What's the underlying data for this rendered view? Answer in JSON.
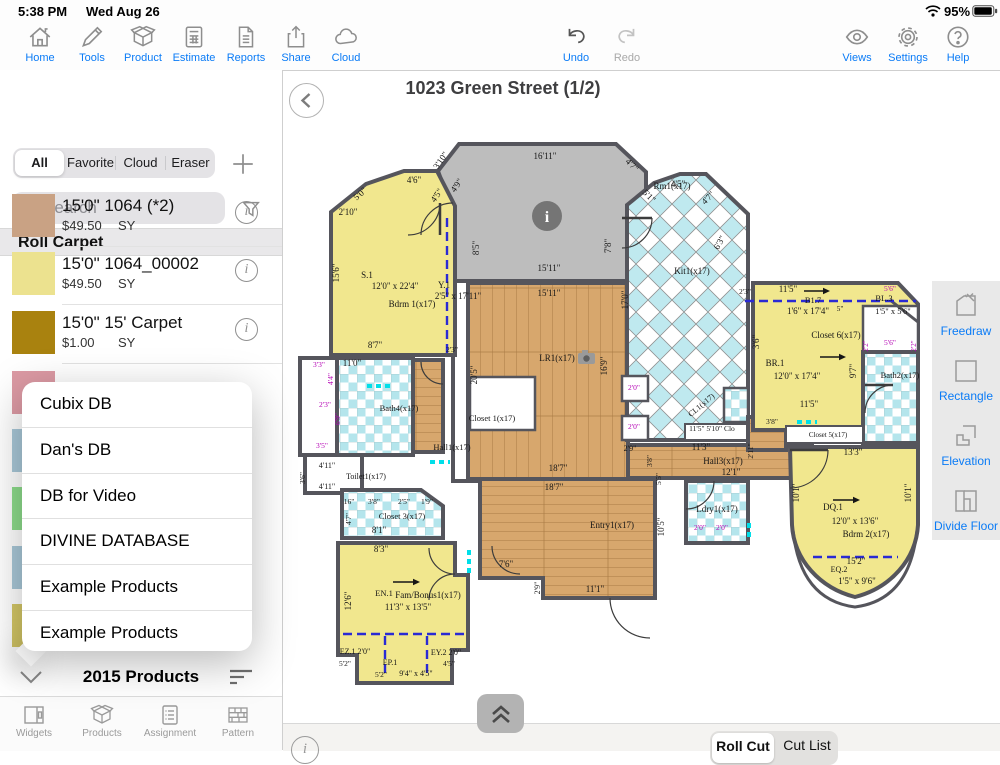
{
  "status_bar": {
    "time": "5:38 PM",
    "date": "Wed Aug 26",
    "battery_percent": "95%"
  },
  "toolbar": {
    "left": [
      {
        "label": "Home"
      },
      {
        "label": "Tools"
      },
      {
        "label": "Product"
      },
      {
        "label": "Estimate"
      },
      {
        "label": "Reports"
      },
      {
        "label": "Share"
      },
      {
        "label": "Cloud"
      }
    ],
    "center": [
      {
        "label": "Undo"
      },
      {
        "label": "Redo"
      }
    ],
    "right": [
      {
        "label": "Views"
      },
      {
        "label": "Settings"
      },
      {
        "label": "Help"
      }
    ]
  },
  "sidebar": {
    "filters": [
      {
        "label": "All"
      },
      {
        "label": "Favorite"
      },
      {
        "label": "Cloud"
      },
      {
        "label": "Eraser"
      }
    ],
    "search": {
      "placeholder": "Search"
    },
    "section_header": "Roll Carpet",
    "products": [
      {
        "name": "15'0\" 1064  (*2)",
        "price": "$49.50",
        "unit": "SY",
        "swatch": "#c9a284"
      },
      {
        "name": "15'0\" 1064_00002",
        "price": "$49.50",
        "unit": "SY",
        "swatch": "#ece28f"
      },
      {
        "name": "15'0\" 15' Carpet",
        "price": "$1.00",
        "unit": "SY",
        "swatch": "#a9820f"
      }
    ],
    "partial_swatches": [
      "#dc9aa4",
      "#a9c8d8",
      "#8ddc8b",
      "#a9c8d8",
      "#d4c766"
    ],
    "db_menu": [
      "Cubix DB",
      "Dan's DB",
      "DB for Video",
      "DIVINE DATABASE",
      "Example Products",
      "Example Products"
    ],
    "footer_label": "2015 Products",
    "tabbar": [
      {
        "label": "Widgets"
      },
      {
        "label": "Products"
      },
      {
        "label": "Assignment"
      },
      {
        "label": "Pattern"
      }
    ]
  },
  "canvas": {
    "title": "1023 Green Street (1/2)",
    "info_marker_glyph": "i",
    "tools": [
      {
        "label": "Freedraw"
      },
      {
        "label": "Rectangle"
      },
      {
        "label": "Elevation"
      },
      {
        "label": "Divide Floor"
      }
    ],
    "bottom_tabs": [
      {
        "label": "Roll Cut"
      },
      {
        "label": "Cut List"
      }
    ],
    "plan": {
      "labels": [
        {
          "t": "16'11\"",
          "x": 545,
          "y": 159
        },
        {
          "t": "Rm1(x17)",
          "x": 672,
          "y": 189
        },
        {
          "t": "15'11\"",
          "x": 549,
          "y": 271
        },
        {
          "t": "15'11\"",
          "x": 549,
          "y": 296
        },
        {
          "t": "8'5\"",
          "x": 479,
          "y": 248,
          "r": -90
        },
        {
          "t": "3'10\"",
          "x": 443,
          "y": 162,
          "r": -55
        },
        {
          "t": "4'9\"",
          "x": 459,
          "y": 187,
          "r": -55
        },
        {
          "t": "4'5\"",
          "x": 439,
          "y": 197,
          "r": -55
        },
        {
          "t": "2'10\"",
          "x": 348,
          "y": 215
        },
        {
          "t": "5'0\"",
          "x": 362,
          "y": 196,
          "r": -42
        },
        {
          "t": "4'6\"",
          "x": 414,
          "y": 183
        },
        {
          "t": "15'6\"",
          "x": 339,
          "y": 273,
          "r": -90
        },
        {
          "t": "S.1",
          "x": 367,
          "y": 278
        },
        {
          "t": "12'0\" x 22'4\"",
          "x": 395,
          "y": 289
        },
        {
          "t": "Y.1",
          "x": 444,
          "y": 288
        },
        {
          "t": "2'5\" x 17'11\"",
          "x": 458,
          "y": 299
        },
        {
          "t": "Bdrm 1(x17)",
          "x": 412,
          "y": 307
        },
        {
          "t": "8'7\"",
          "x": 375,
          "y": 348
        },
        {
          "t": "4'7\"",
          "x": 630,
          "y": 167,
          "r": 45
        },
        {
          "t": "5'1\"",
          "x": 647,
          "y": 198,
          "r": 45
        },
        {
          "t": "4'5\"",
          "x": 678,
          "y": 187
        },
        {
          "t": "4'7\"",
          "x": 710,
          "y": 200,
          "r": -45
        },
        {
          "t": "7'8\"",
          "x": 611,
          "y": 246,
          "r": -90
        },
        {
          "t": "Kit1(x17)",
          "x": 692,
          "y": 274
        },
        {
          "t": "6'3\"",
          "x": 722,
          "y": 244,
          "r": -60
        },
        {
          "t": "2'3\"",
          "x": 745,
          "y": 294,
          "s": 7.5
        },
        {
          "t": "17'0\"",
          "x": 628,
          "y": 300,
          "r": -90
        },
        {
          "t": "16'9\"",
          "x": 607,
          "y": 366,
          "r": -90
        },
        {
          "t": "LR1(x17)",
          "x": 557,
          "y": 361
        },
        {
          "t": "20'5\"",
          "x": 477,
          "y": 375,
          "r": -90
        },
        {
          "t": "18'7\"",
          "x": 558,
          "y": 471
        },
        {
          "t": "18'7\"",
          "x": 554,
          "y": 490
        },
        {
          "t": "Entry1(x17)",
          "x": 612,
          "y": 528
        },
        {
          "t": "11'1\"",
          "x": 595,
          "y": 592
        },
        {
          "t": "Hall3(x17)",
          "x": 723,
          "y": 464
        },
        {
          "t": "11'3\"",
          "x": 701,
          "y": 450
        },
        {
          "t": "12'1\"",
          "x": 731,
          "y": 475
        },
        {
          "t": "2'9\"",
          "x": 630,
          "y": 451,
          "s": 8
        },
        {
          "t": "3'8\"",
          "x": 652,
          "y": 461,
          "r": -90,
          "s": 7.5
        },
        {
          "t": "5'5\"",
          "x": 661,
          "y": 479,
          "r": -90,
          "s": 7.5
        },
        {
          "t": "10'5\"",
          "x": 664,
          "y": 527,
          "r": -90
        },
        {
          "t": "Ldry1(x17)",
          "x": 717,
          "y": 512
        },
        {
          "t": "Closet 1(x17)",
          "x": 492,
          "y": 421,
          "s": 8.5
        },
        {
          "t": "Hall1(x17)",
          "x": 452,
          "y": 450,
          "s": 8.5
        },
        {
          "t": "Toilet1(x17)",
          "x": 366,
          "y": 479,
          "s": 8
        },
        {
          "t": "Bath4(x17)",
          "x": 399,
          "y": 411,
          "s": 8.5
        },
        {
          "t": "11'0\"",
          "x": 352,
          "y": 366
        },
        {
          "t": "Closet 3(x17)",
          "x": 402,
          "y": 519,
          "s": 8.5
        },
        {
          "t": "8'1\"",
          "x": 379,
          "y": 533
        },
        {
          "t": "8'3\"",
          "x": 381,
          "y": 552
        },
        {
          "t": "12'6\"",
          "x": 351,
          "y": 601,
          "r": -90
        },
        {
          "t": "EN.1",
          "x": 384,
          "y": 596,
          "s": 8.5
        },
        {
          "t": "Fam/Bonus1(x17)",
          "x": 428,
          "y": 598
        },
        {
          "t": "11'3\" x 13'5\"",
          "x": 408,
          "y": 610
        },
        {
          "t": "7'6\"",
          "x": 506,
          "y": 567
        },
        {
          "t": "2'9\"",
          "x": 540,
          "y": 588,
          "r": -90,
          "s": 8
        },
        {
          "t": "EZ.1 2'0\"",
          "x": 355,
          "y": 654,
          "s": 8
        },
        {
          "t": "EY.2 2'0\"",
          "x": 446,
          "y": 655,
          "s": 8
        },
        {
          "t": "EP.1",
          "x": 390,
          "y": 665,
          "s": 8
        },
        {
          "t": "9'4\" x 4'5\"",
          "x": 416,
          "y": 676,
          "s": 8
        },
        {
          "t": "5'2\"",
          "x": 345,
          "y": 666,
          "s": 7.5
        },
        {
          "t": "5'2\"",
          "x": 381,
          "y": 677,
          "s": 7.5
        },
        {
          "t": "4'5\"",
          "x": 449,
          "y": 666,
          "s": 7.5
        },
        {
          "t": "11'5\"",
          "x": 788,
          "y": 292
        },
        {
          "t": "B1.7",
          "x": 813,
          "y": 303,
          "s": 8.5
        },
        {
          "t": "1'6\" x 17'4\"",
          "x": 808,
          "y": 314
        },
        {
          "t": "5\"",
          "x": 840,
          "y": 311,
          "s": 7.5
        },
        {
          "t": "BL.3",
          "x": 884,
          "y": 301,
          "s": 8.5
        },
        {
          "t": "1'5\" x 5'6\"",
          "x": 893,
          "y": 314,
          "s": 8.5
        },
        {
          "t": "5'6\"",
          "x": 890,
          "y": 291,
          "c": "p",
          "s": 7.5
        },
        {
          "t": "Closet 6(x17)",
          "x": 836,
          "y": 338
        },
        {
          "t": "3'6\"",
          "x": 759,
          "y": 342,
          "r": -90
        },
        {
          "t": "BR.1",
          "x": 775,
          "y": 366
        },
        {
          "t": "12'0\" x 17'4\"",
          "x": 797,
          "y": 379
        },
        {
          "t": "11'5\"",
          "x": 809,
          "y": 407
        },
        {
          "t": "9'7\"",
          "x": 856,
          "y": 371,
          "r": -90
        },
        {
          "t": "Bath2(x17)",
          "x": 900,
          "y": 378,
          "s": 8.5
        },
        {
          "t": "5'6\"",
          "x": 890,
          "y": 345,
          "c": "p",
          "s": 7.5
        },
        {
          "t": "2'2\"",
          "x": 868,
          "y": 346,
          "r": -90,
          "c": "p",
          "s": 7
        },
        {
          "t": "2'2\"",
          "x": 916,
          "y": 346,
          "r": -90,
          "c": "p",
          "s": 7
        },
        {
          "t": "Closet 5(x17)",
          "x": 828,
          "y": 437,
          "s": 7
        },
        {
          "t": "3'8\"",
          "x": 772,
          "y": 424,
          "s": 7.5
        },
        {
          "t": "2'11\"",
          "x": 753,
          "y": 451,
          "r": -90,
          "s": 7.5
        },
        {
          "t": "13'3\"",
          "x": 853,
          "y": 455
        },
        {
          "t": "10'1\"",
          "x": 799,
          "y": 493,
          "r": -90
        },
        {
          "t": "10'1\"",
          "x": 911,
          "y": 493,
          "r": -90
        },
        {
          "t": "DQ.1",
          "x": 833,
          "y": 510
        },
        {
          "t": "12'0\" x 13'6\"",
          "x": 855,
          "y": 524
        },
        {
          "t": "Bdrm 2(x17)",
          "x": 866,
          "y": 537
        },
        {
          "t": "15'2\"",
          "x": 856,
          "y": 564
        },
        {
          "t": "EQ.2",
          "x": 839,
          "y": 572,
          "s": 8
        },
        {
          "t": "1'5\" x 9'6\"",
          "x": 857,
          "y": 584
        },
        {
          "t": "11'5\" 5'10\" Clo",
          "x": 712,
          "y": 431,
          "s": 7.5
        },
        {
          "t": "CL1(x17)",
          "x": 703,
          "y": 407,
          "r": -40,
          "s": 8
        },
        {
          "t": "2'0\"",
          "x": 634,
          "y": 390,
          "c": "p",
          "s": 7.5
        },
        {
          "t": "2'0\"",
          "x": 634,
          "y": 429,
          "c": "p",
          "s": 7.5
        },
        {
          "t": "2'0\"",
          "x": 700,
          "y": 530,
          "c": "p",
          "s": 7.5
        },
        {
          "t": "2'0\"",
          "x": 722,
          "y": 530,
          "c": "p",
          "s": 7.5
        },
        {
          "t": "3'3\"",
          "x": 319,
          "y": 367,
          "c": "p",
          "s": 7.5
        },
        {
          "t": "4'4\"",
          "x": 333,
          "y": 379,
          "r": -90,
          "c": "p",
          "s": 7.5
        },
        {
          "t": "2'3\"",
          "x": 325,
          "y": 407,
          "c": "p",
          "s": 7.5
        },
        {
          "t": "6'9\"",
          "x": 340,
          "y": 419,
          "r": -90,
          "c": "p",
          "s": 7.5
        },
        {
          "t": "3'5\"",
          "x": 322,
          "y": 448,
          "c": "p",
          "s": 7.5
        },
        {
          "t": "4'11\"",
          "x": 327,
          "y": 468,
          "s": 8
        },
        {
          "t": "4'11\"",
          "x": 327,
          "y": 489,
          "s": 8
        },
        {
          "t": "3'6\"",
          "x": 305,
          "y": 478,
          "r": -90,
          "s": 7.5
        },
        {
          "t": "16\"",
          "x": 349,
          "y": 504,
          "s": 7.5
        },
        {
          "t": "3'8\"",
          "x": 374,
          "y": 504,
          "s": 7.5
        },
        {
          "t": "2'5\"",
          "x": 404,
          "y": 504,
          "s": 7.5
        },
        {
          "t": "1'9\"",
          "x": 427,
          "y": 504,
          "s": 7.5
        },
        {
          "t": "4'7\"",
          "x": 351,
          "y": 519,
          "r": -90,
          "s": 7.5
        },
        {
          "t": "2'3\"",
          "x": 452,
          "y": 352,
          "s": 7.5
        }
      ],
      "dashes_blue": [
        [
          447,
          218,
          447,
          356
        ],
        [
          745,
          301,
          916,
          301
        ],
        [
          813,
          557,
          898,
          557
        ],
        [
          343,
          634,
          467,
          634
        ],
        [
          385,
          636,
          385,
          676
        ],
        [
          427,
          636,
          427,
          676
        ]
      ],
      "dashes_cyan": [
        [
          367,
          386,
          393,
          386
        ],
        [
          430,
          462,
          450,
          462
        ],
        [
          469,
          550,
          469,
          577
        ],
        [
          749,
          523,
          749,
          540
        ],
        [
          797,
          422,
          817,
          422
        ]
      ],
      "arrows": [
        [
          393,
          582,
          420,
          582
        ],
        [
          833,
          500,
          860,
          500
        ],
        [
          804,
          291,
          830,
          291
        ],
        [
          820,
          357,
          846,
          357
        ]
      ]
    }
  }
}
